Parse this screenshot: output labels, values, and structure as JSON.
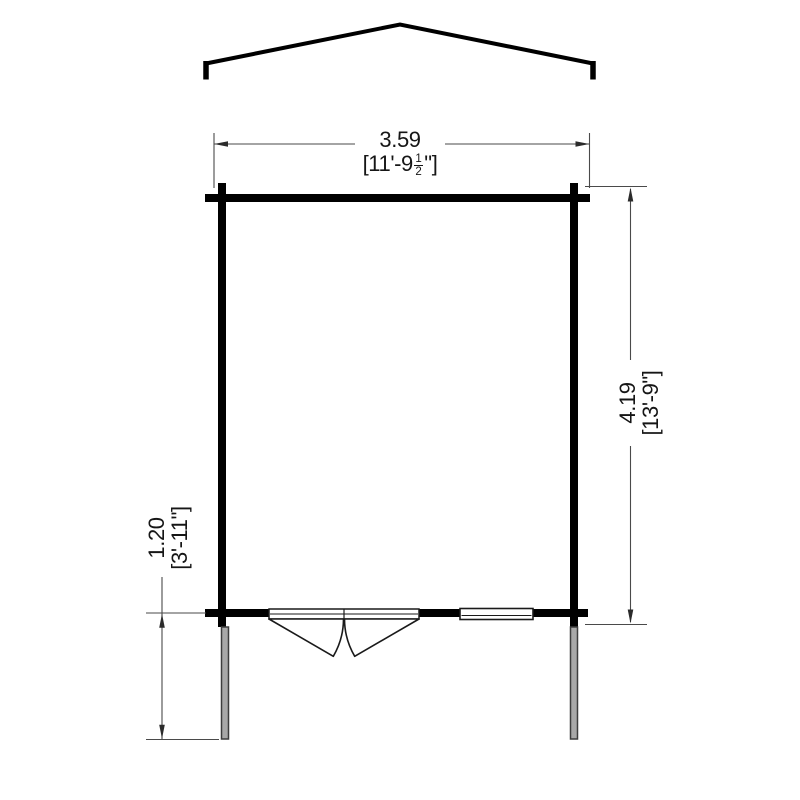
{
  "drawing": {
    "type": "floor-plan-with-roof-profile",
    "line_color": "#000000",
    "dimension_line_color": "#4a4a4a",
    "post_fill_color": "#a8a8a8"
  },
  "dimensions": {
    "width": {
      "metric": "3.59",
      "imperial_prefix": "[11'-9",
      "fraction_numerator": "1",
      "fraction_denominator": "2",
      "imperial_suffix": "\"]"
    },
    "height": {
      "metric": "4.19",
      "imperial": "[13'-9\"]"
    },
    "front_projection": {
      "metric": "1.20",
      "imperial": "[3'-11\"]"
    }
  }
}
